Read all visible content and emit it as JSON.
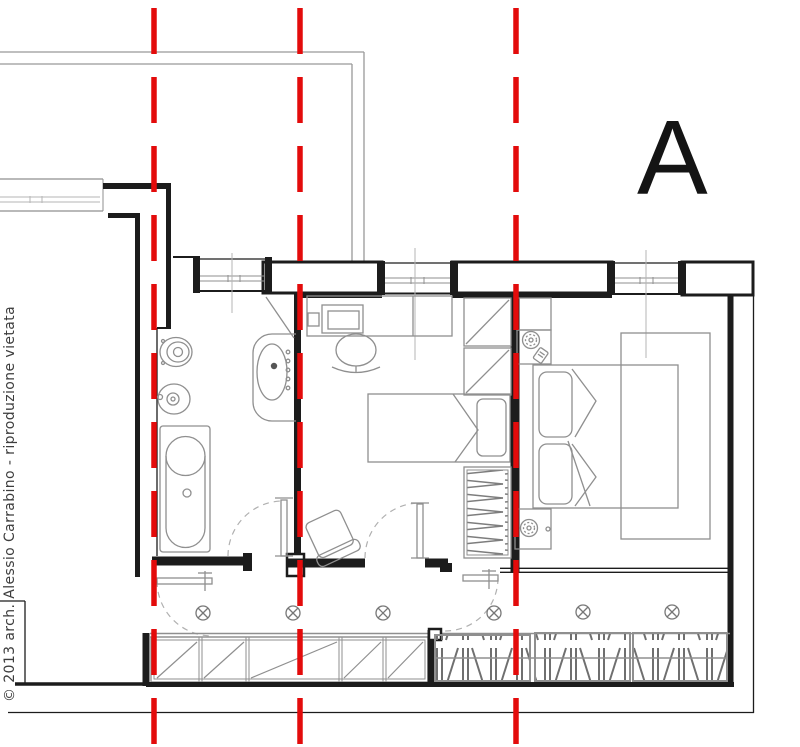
{
  "drawing": {
    "type": "architectural-floor-plan",
    "section_label": "A",
    "copyright": "© 2013 arch. Alessio Carrabino - riproduzione vietata",
    "colors": {
      "section_line_red": "#e30b0b",
      "wall_black": "#1c1c1c",
      "fixture_gray": "#8f8f8f",
      "outline_gray": "#999999",
      "background": "#ffffff"
    },
    "section_lines": {
      "count": 3,
      "orientation": "vertical",
      "style": "red long-dash",
      "x_positions_px": [
        154,
        300,
        516
      ]
    },
    "ceiling_lights": {
      "symbol": "circle-with-x",
      "count": 6,
      "row_y_px": 613
    },
    "rooms": [
      "bathroom",
      "studio",
      "bedroom",
      "balcony-corridor"
    ],
    "fixtures": {
      "bathroom": [
        "toilet",
        "bidet",
        "washbasin",
        "bathtub"
      ],
      "studio": [
        "desk",
        "computer",
        "office-chair",
        "single-bed",
        "wardrobe-shelves",
        "wardrobe-hangers",
        "armchair"
      ],
      "bedroom": [
        "double-bed",
        "pillows",
        "nightstands",
        "table-lamps",
        "rug"
      ],
      "balcony": [
        "glazed-panels",
        "louvered-shutters",
        "swing-doors"
      ]
    }
  }
}
